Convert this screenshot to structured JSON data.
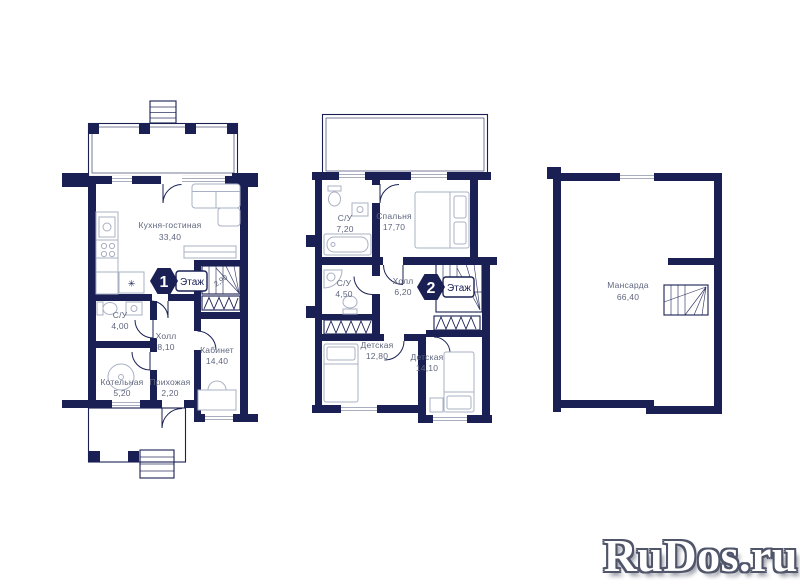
{
  "page": {
    "background": "#ffffff"
  },
  "colors": {
    "wall": "#1a2053",
    "furniture_line": "#a9b0c3",
    "label_text": "#5f677f",
    "badge_fill": "#1a2053",
    "badge_number": "#ffffff",
    "watermark_fill": "#ffffff",
    "watermark_outline": "#50556a"
  },
  "symbols": {
    "fridge": "✳"
  },
  "plans": [
    {
      "title_number": "1",
      "title_label": "Этаж",
      "stair_dimension": "2,90",
      "rooms": [
        {
          "name": "Кухня-гостиная",
          "area": "33,40"
        },
        {
          "name": "С/У",
          "area": "4,00"
        },
        {
          "name": "Холл",
          "area": "8,10"
        },
        {
          "name": "Кабинет",
          "area": "14,40"
        },
        {
          "name": "Котельная",
          "area": "5,20"
        },
        {
          "name": "Прихожая",
          "area": "2,20"
        }
      ]
    },
    {
      "title_number": "2",
      "title_label": "Этаж",
      "rooms": [
        {
          "name": "С/У",
          "area": "7,20"
        },
        {
          "name": "Спальня",
          "area": "17,70"
        },
        {
          "name": "С/У",
          "area": "4,50"
        },
        {
          "name": "Холл",
          "area": "6,20"
        },
        {
          "name": "Детская",
          "area": "12,80"
        },
        {
          "name": "Детская",
          "area": "14,10"
        }
      ]
    },
    {
      "rooms": [
        {
          "name": "Мансарда",
          "area": "66,40"
        }
      ]
    }
  ],
  "watermark": {
    "text": "RuDos.ru"
  }
}
